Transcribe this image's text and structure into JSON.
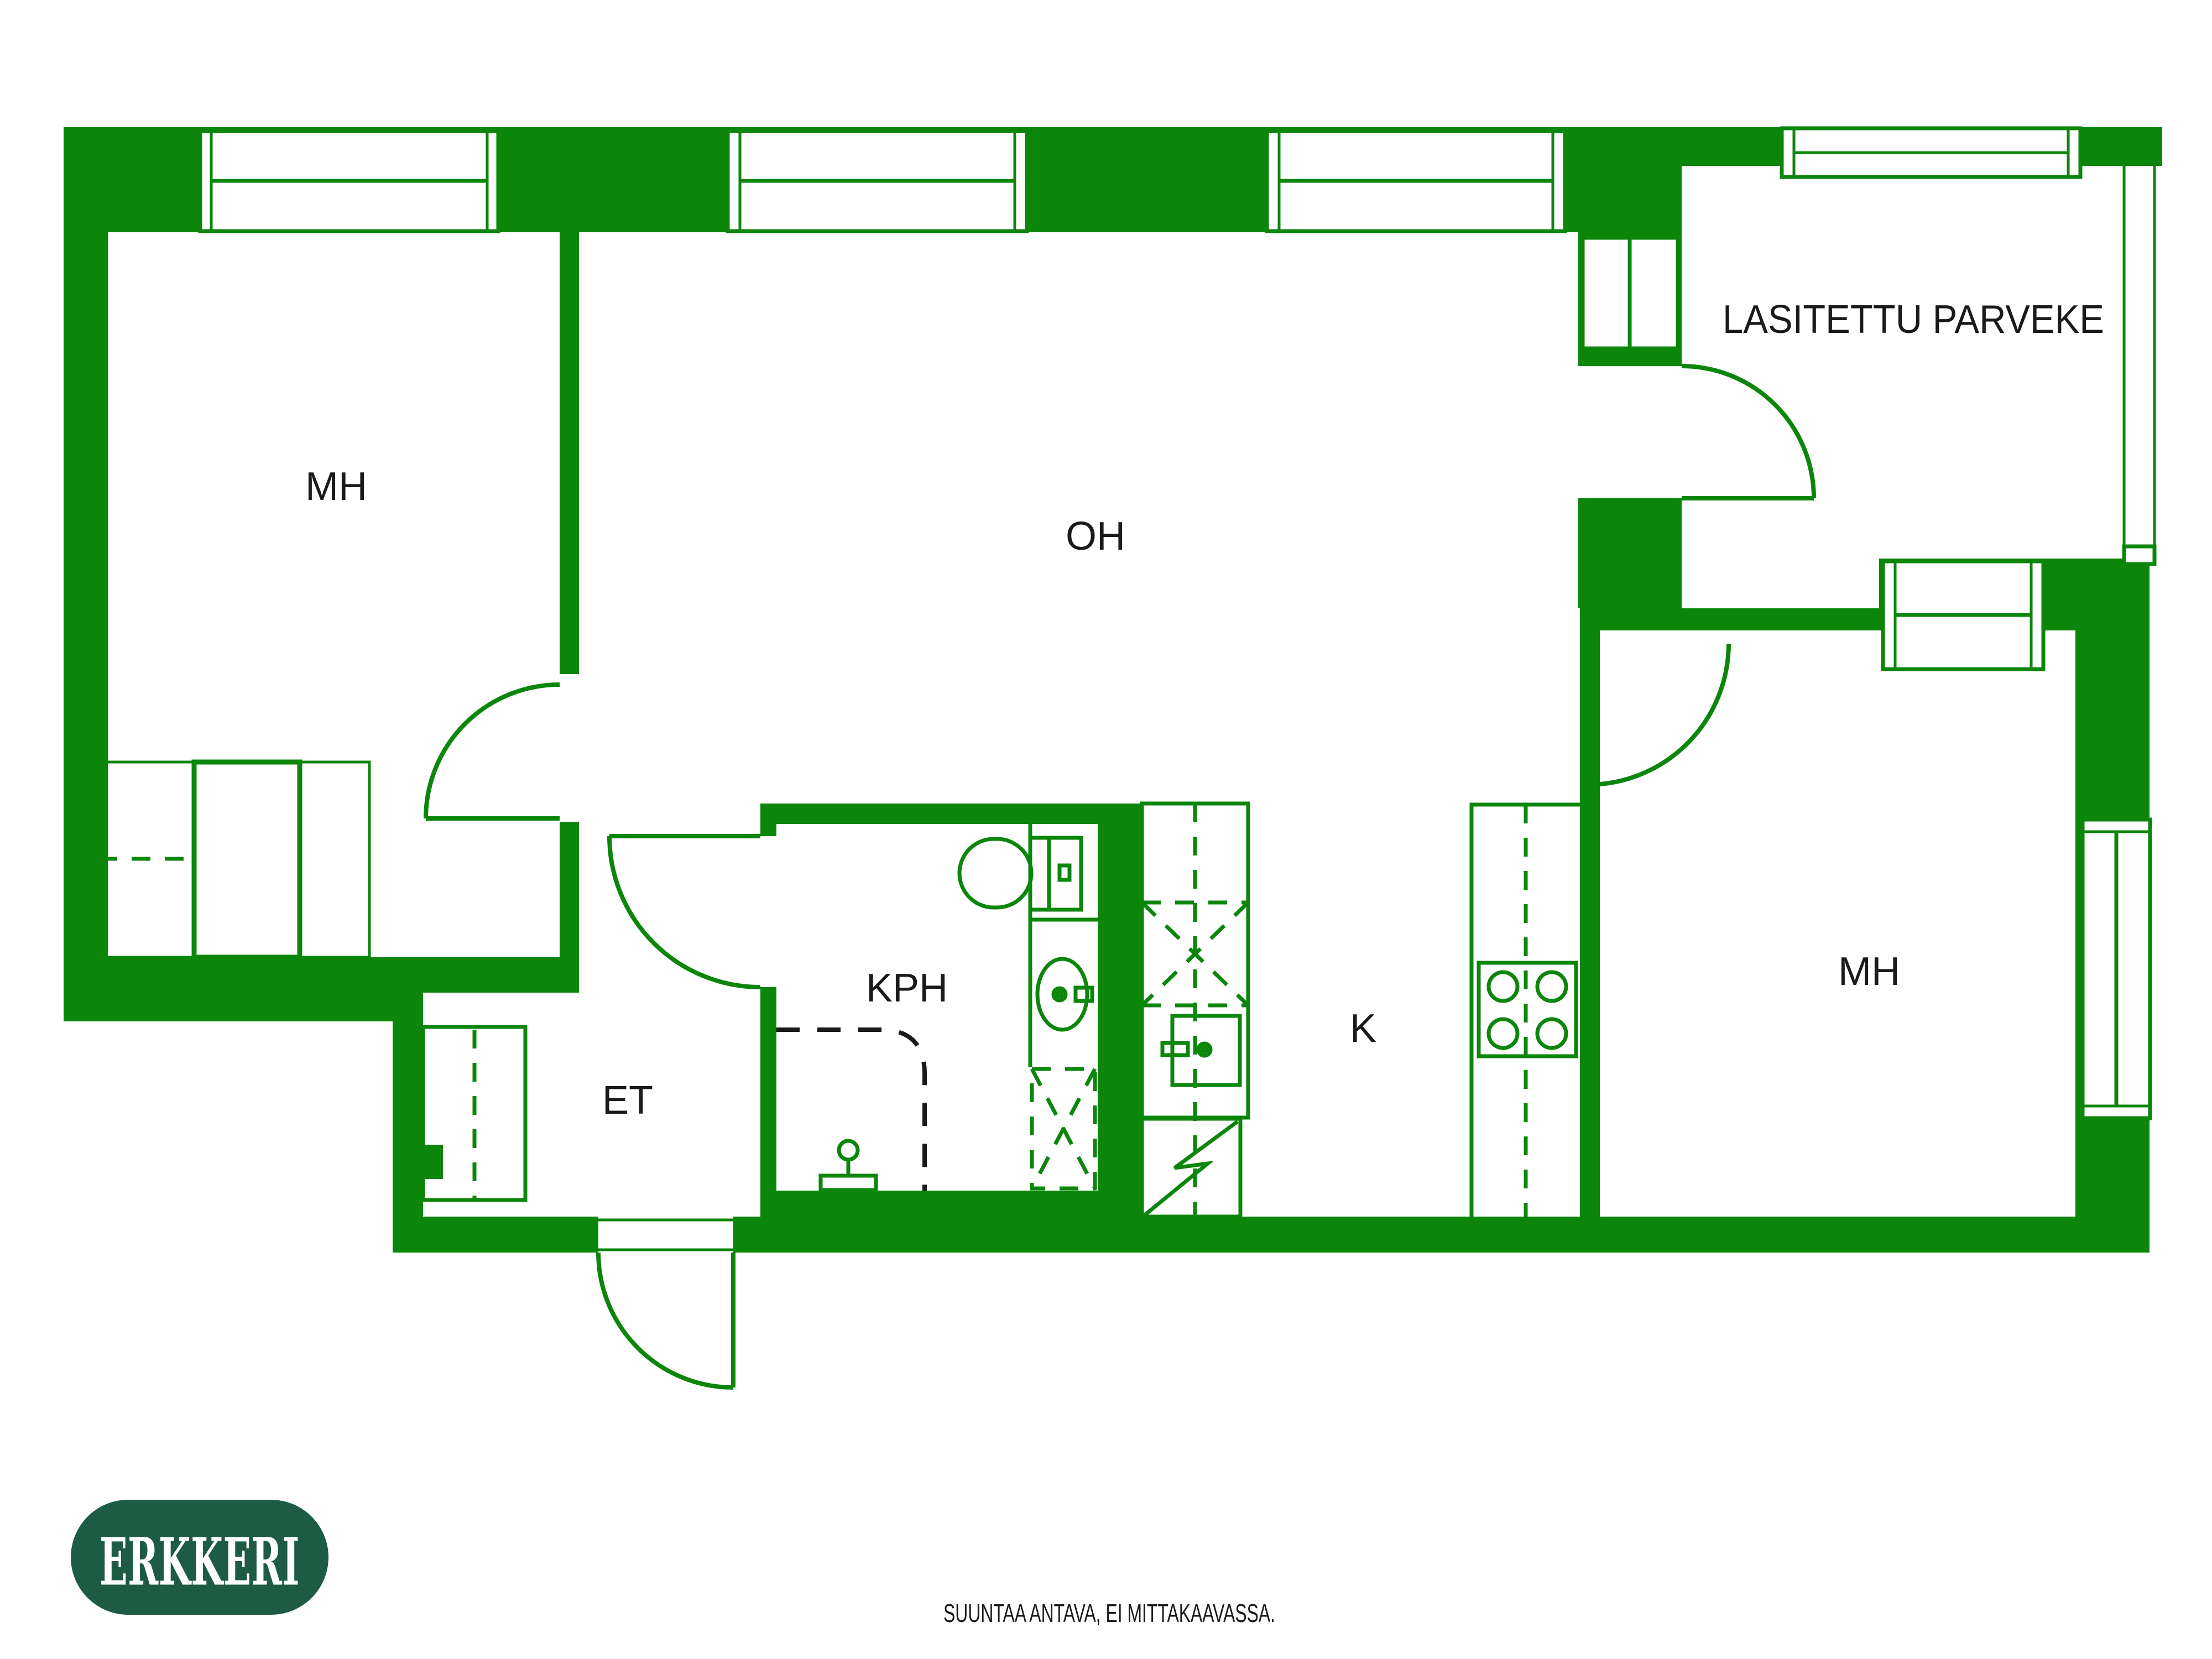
{
  "rooms": {
    "mh_left": "MH",
    "oh": "OH",
    "balcony": "LASITETTU PARVEKE",
    "mh_right": "MH",
    "kph": "KPH",
    "et": "ET",
    "k": "K"
  },
  "logo": {
    "text": "ERKKERI"
  },
  "footer": {
    "disclaimer": "SUUNTAA ANTAVA, EI MITTAKAAVASSA."
  },
  "colors": {
    "wall": "#0b860b",
    "ink": "#1a1a1a",
    "floor": "#ffffff",
    "logo_bg": "#1d5b45",
    "logo_text": "#ffffff"
  }
}
